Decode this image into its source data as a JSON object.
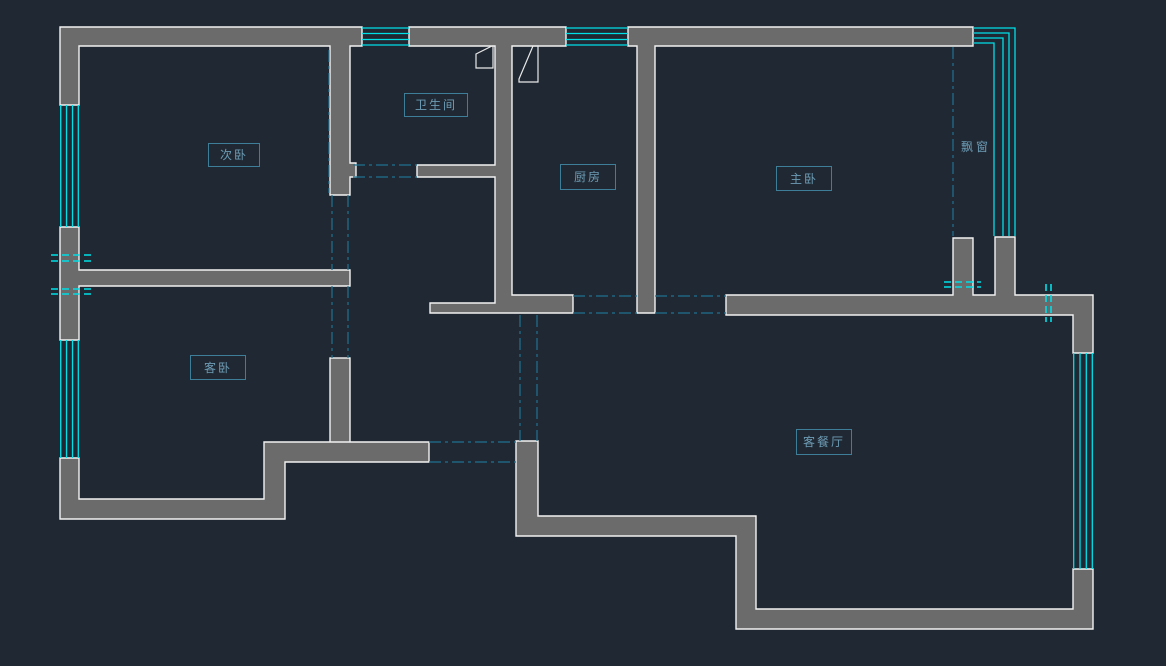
{
  "drawing": {
    "type": "apartment floor plan (CAD)",
    "rooms": [
      {
        "id": "bedroom2",
        "label": "次卧"
      },
      {
        "id": "bathroom",
        "label": "卫生间"
      },
      {
        "id": "kitchen",
        "label": "厨房"
      },
      {
        "id": "master-bedroom",
        "label": "主卧"
      },
      {
        "id": "guest-bedroom",
        "label": "客卧"
      },
      {
        "id": "living-dining",
        "label": "客餐厅"
      },
      {
        "id": "bay-window",
        "label": "飘窗"
      }
    ],
    "colors": {
      "background": "#202933",
      "wall_fill": "#6b6b6b",
      "wall_outline": "#f2f2f2",
      "window_glass": "#00e0e8",
      "opening_centerline": "#1f7291",
      "label_text": "#6d9cb5",
      "label_box": "#3f7e98"
    }
  }
}
